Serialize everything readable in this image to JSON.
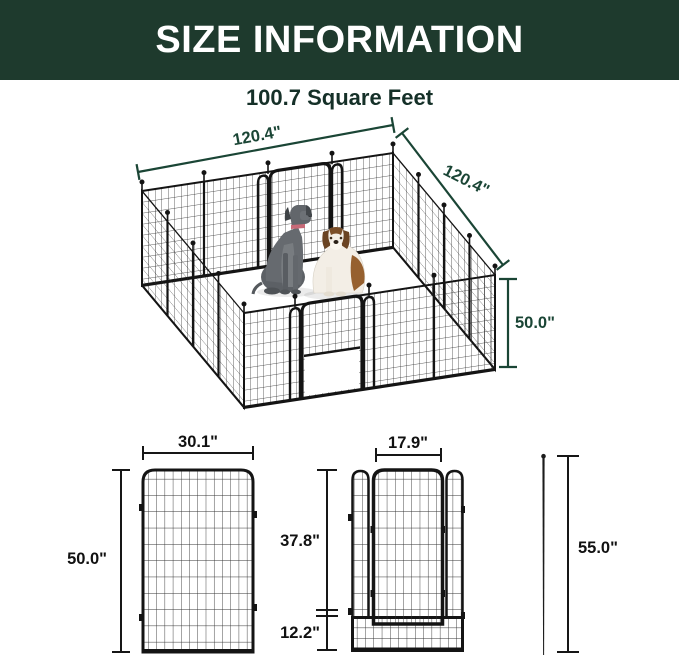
{
  "header": {
    "title": "SIZE INFORMATION"
  },
  "subtitle": "100.7 Square Feet",
  "colors": {
    "banner_green": "#1e3a2d",
    "dimension_green": "#1a4535",
    "drawing_ink": "#161616"
  },
  "isometric_pen": {
    "top_width": "120.4\"",
    "side_width": "120.4\"",
    "height": "50.0\"",
    "contents": "16-panel mesh dog playpen with two doors and two dogs inside"
  },
  "panel_drawing": {
    "width": "30.1\"",
    "height": "50.0\""
  },
  "door_panel_drawing": {
    "door_width": "17.9\"",
    "door_height": "37.8\"",
    "bottom_height": "12.2\""
  },
  "stake_drawing": {
    "length": "55.0\""
  }
}
